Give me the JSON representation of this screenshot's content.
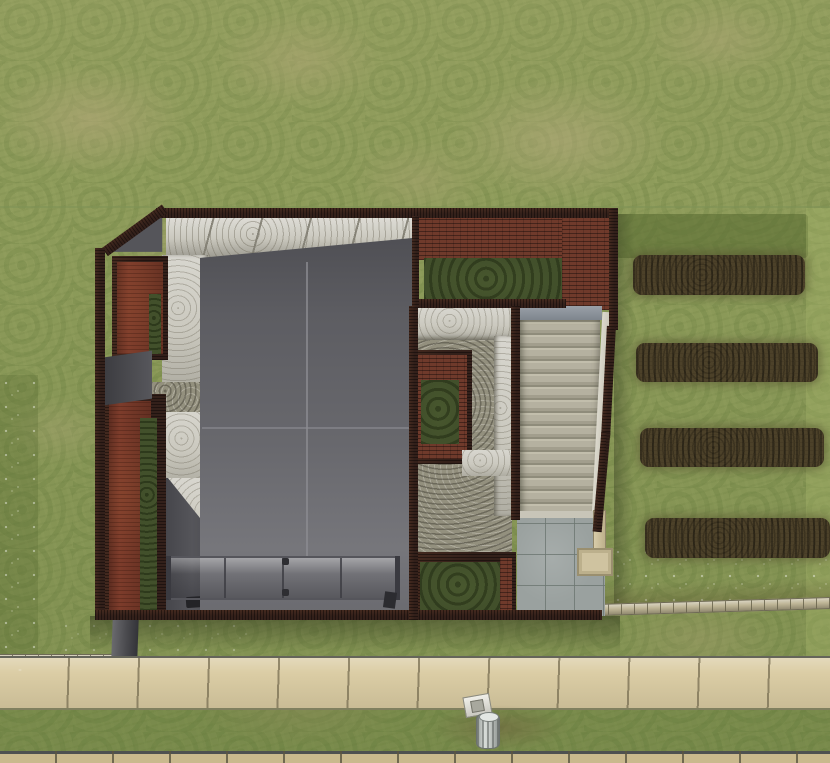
{
  "meta": {
    "genre": "life-simulation game",
    "view": "top-down lot view",
    "scene_summary": "Aerial view of a modern flat-roofed house on a grassy lot with a wide exterior staircase, brick terrace, gravel courtyards, wooden planter decks, four tilled garden plots to the east, a stone ledge, public sidewalk, curb-side mailbox and trash can"
  },
  "scene": {
    "objects": {
      "lawn": "Grass terrain",
      "sand_patches": "Worn sandy grass patches",
      "flower_patches": "Wildflower grass patches",
      "garden_plot": "Tilled soil garden plot",
      "stone_ledge": "Low stone garden ledge",
      "retaining_wall": "Concrete retaining wall",
      "sidewalk": "Public sidewalk",
      "road_curb": "Street curb",
      "verge": "Grass verge strip",
      "mailbox": "Mailbox",
      "trash_can": "Outdoor trash can",
      "house": "Modern house",
      "roof": "Flat metal roof",
      "concrete_wall": "Poured concrete wall",
      "wood_wall": "Dark wood exterior wall",
      "garage_door": "Metal garage door",
      "door_sill": "Light door sill",
      "brick_terrace": "Brick roof terrace",
      "terrace_lawn": "Sunken terrace lawn",
      "gravel_court": "Gravel courtyard",
      "planter_bed": "Raised planter bed",
      "court_lawn": "Lower grass courtyard",
      "staircase": "Exterior staircase",
      "stair_landing": "Stair landing",
      "patio": "Concrete tile patio",
      "arbor": "Wooden arbor post and box",
      "deck_planter_upper": "Upper wood deck planter with hedge",
      "deck_planter_lower": "Lower wood deck planter with hedge",
      "hedge": "Hedge strip",
      "entry": "Side entry passage",
      "doormat": "Dark doormat",
      "roof_shadow": "Cast shadow"
    },
    "counts": {
      "garden_plots": 4,
      "stair_treads": 15,
      "roof_panels": 4,
      "garage_door_segments": 4
    }
  },
  "colors": {
    "grass": "#8d9b5a",
    "sand": "#b6a97b",
    "soil": "#4c4129",
    "wood": "#33201a",
    "deck": "#7d3c2b",
    "brick": "#6f3a2b",
    "conc": "#cbc9bf",
    "roof_dark": "#4e4e53",
    "roof_light": "#76767b",
    "gravel": "#93907e",
    "courtgrass": "#42502b",
    "tread": "#b7b3a2",
    "patio": "#9aa19f",
    "walk": "#dbcda5",
    "ledge": "#bfb697",
    "tan": "#cfc3a0",
    "white": "#e9e9e3",
    "trash": "#c6cbc7"
  }
}
